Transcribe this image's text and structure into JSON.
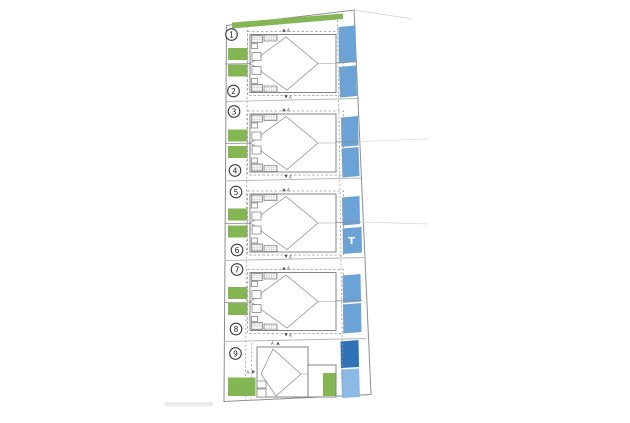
{
  "colors": {
    "green": "#84b654",
    "blue": "#6ba3d6",
    "blue_dark": "#2f72b5",
    "blue_light": "#8cb9e6",
    "line": "#8d8d8d",
    "dashed": "#9a9a9a",
    "circle_stroke": "#3a3a3a"
  },
  "plots": [
    "1",
    "2",
    "3",
    "4",
    "5",
    "6",
    "7",
    "8",
    "9"
  ],
  "labels": {
    "transformer": "T",
    "section_marker": "A"
  }
}
